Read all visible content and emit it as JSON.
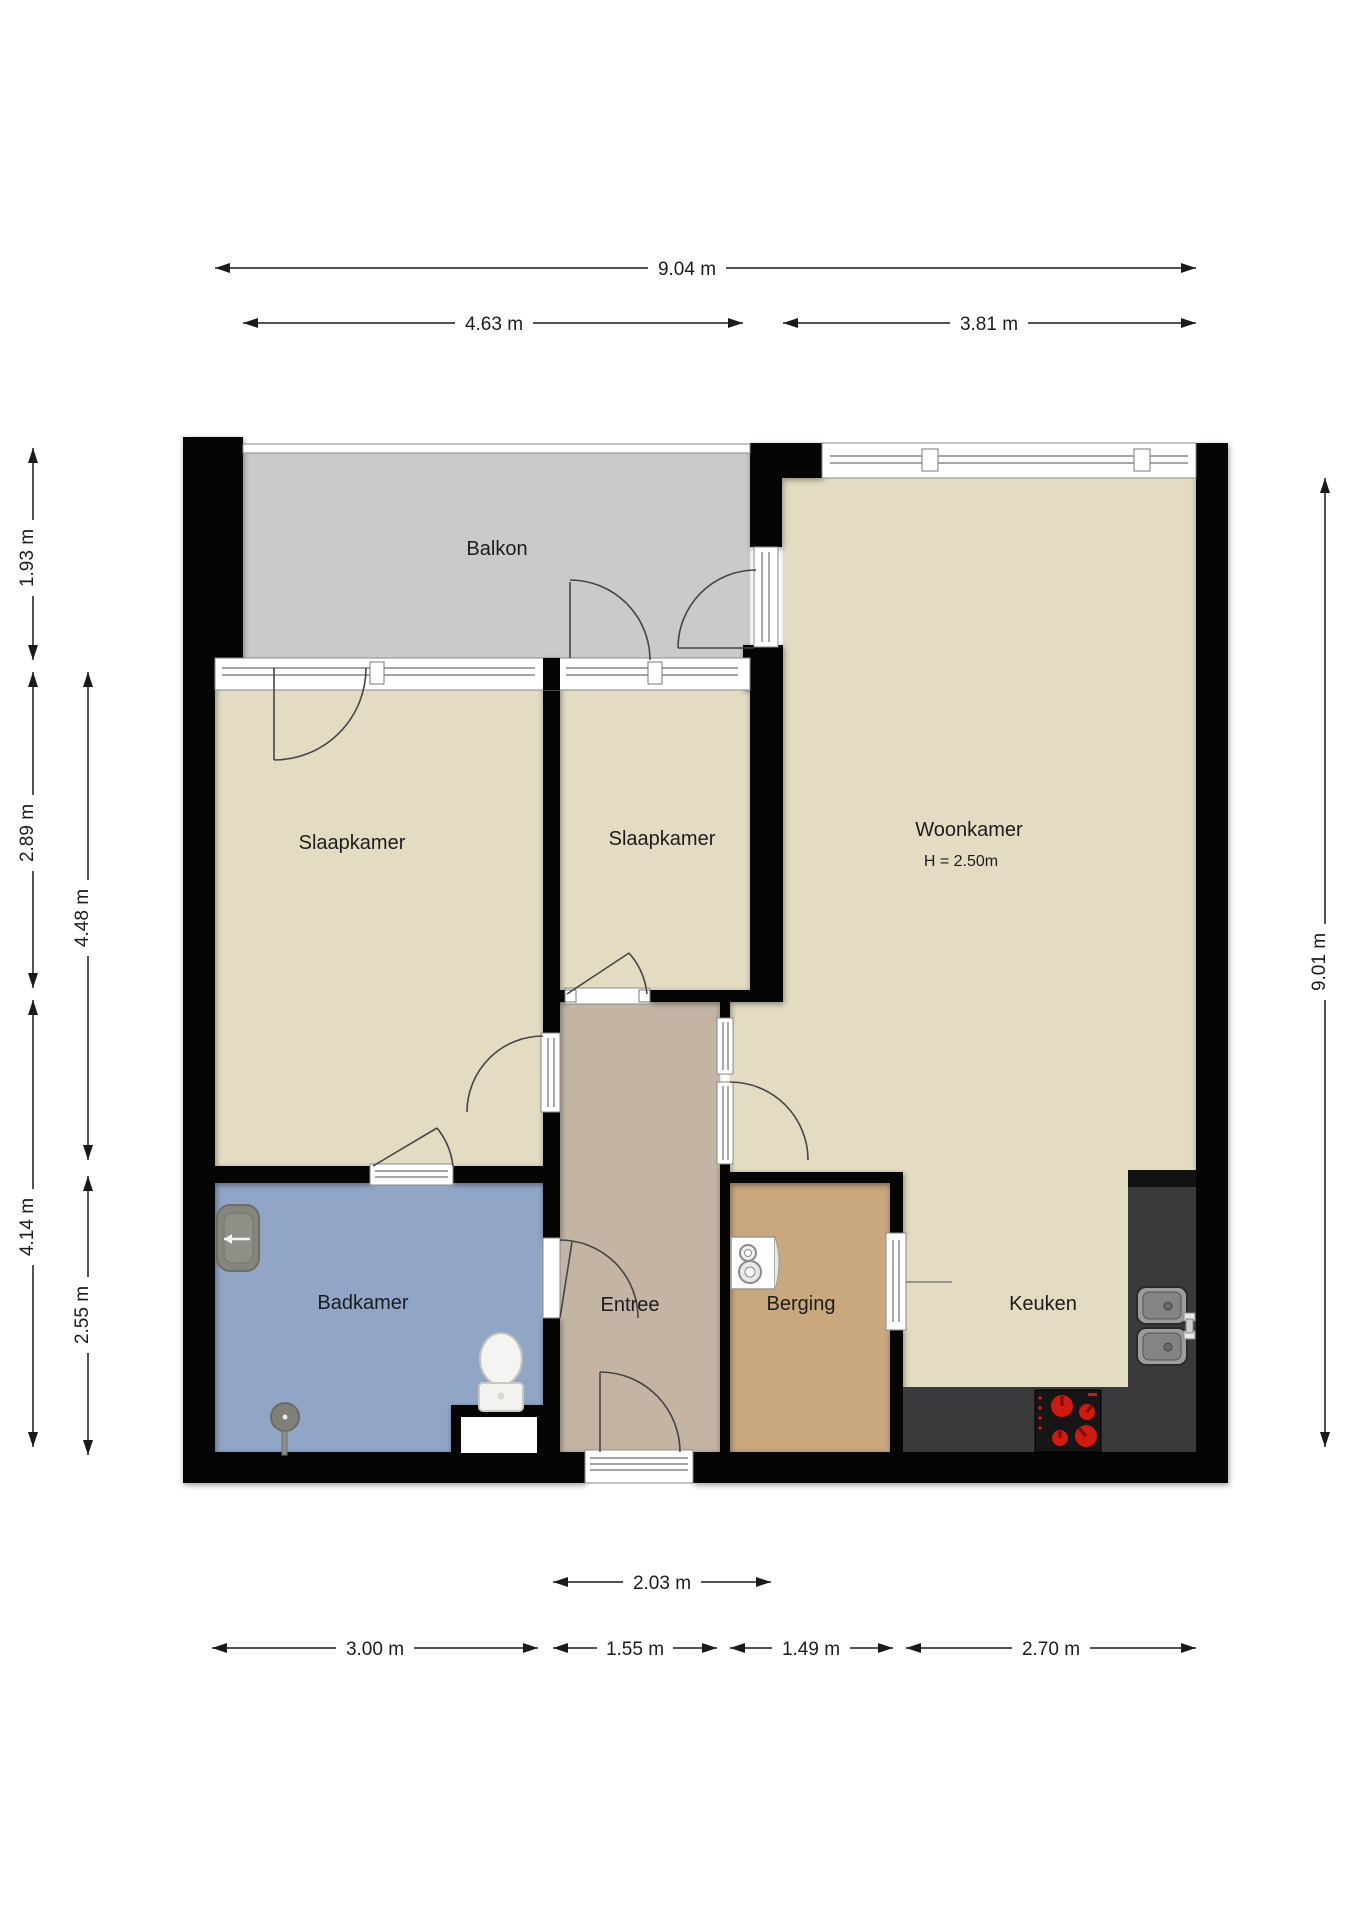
{
  "plan_type": "apartment floor plan",
  "rooms": [
    {
      "id": "balkon",
      "label": "Balkon"
    },
    {
      "id": "slaapkamer-1",
      "label": "Slaapkamer"
    },
    {
      "id": "slaapkamer-2",
      "label": "Slaapkamer"
    },
    {
      "id": "woonkamer",
      "label": "Woonkamer",
      "height_note": "H = 2.50m"
    },
    {
      "id": "badkamer",
      "label": "Badkamer"
    },
    {
      "id": "entree",
      "label": "Entree"
    },
    {
      "id": "berging",
      "label": "Berging"
    },
    {
      "id": "keuken",
      "label": "Keuken"
    }
  ],
  "dimensions": {
    "top": [
      {
        "label": "9.04 m"
      },
      {
        "label": "4.63 m"
      },
      {
        "label": "3.81 m"
      }
    ],
    "left": [
      {
        "label": "1.93 m"
      },
      {
        "label": "2.89 m"
      },
      {
        "label": "4.14 m"
      },
      {
        "label": "4.48 m"
      },
      {
        "label": "2.55 m"
      }
    ],
    "right": [
      {
        "label": "9.01 m"
      }
    ],
    "bottom": [
      {
        "label": "2.03 m"
      },
      {
        "label": "3.00 m"
      },
      {
        "label": "1.55 m"
      },
      {
        "label": "1.49 m"
      },
      {
        "label": "2.70 m"
      }
    ]
  },
  "fixtures": [
    "balcony-railing",
    "washbasin",
    "shower",
    "toilet",
    "vanity-basin",
    "boiler-washing-machine",
    "kitchen-double-sink",
    "kitchen-faucet",
    "cooktop-4-burners",
    "kitchen-counter"
  ],
  "colors": {
    "wall": "#050505",
    "floor_beige": "#e3dcc3",
    "floor_balcony": "#cacaca",
    "floor_bathroom": "#91a6c6",
    "floor_entree": "#c3b4a4",
    "floor_berging": "#c8a87c",
    "counter_dark": "#3a3a3d",
    "burner_red": "#cf1a10",
    "dimension_text": "#1a1a1a"
  }
}
